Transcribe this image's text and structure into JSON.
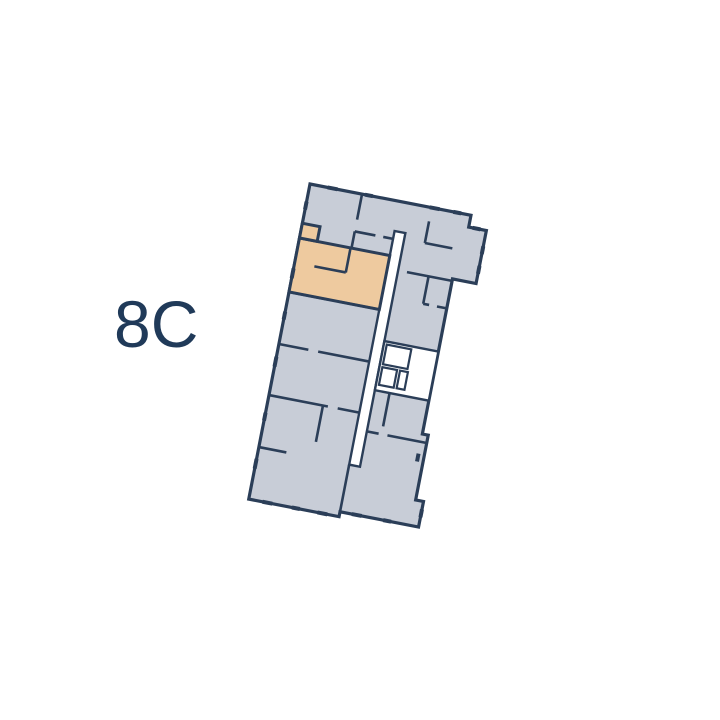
{
  "unit": {
    "label": "8C"
  },
  "floor_plan": {
    "selected_unit": "8C",
    "highlighted_rooms": "selected apartment with balcony",
    "elements": [
      "building-outline",
      "corridor",
      "elevator-core",
      "apartment-rooms",
      "window-ticks"
    ]
  },
  "colors": {
    "background": "#ffffff",
    "wall": "#2b3e58",
    "floor_fill": "#c8cdd7",
    "selected_fill": "#eeca9f",
    "label_text": "#203a59",
    "void": "#ffffff"
  }
}
